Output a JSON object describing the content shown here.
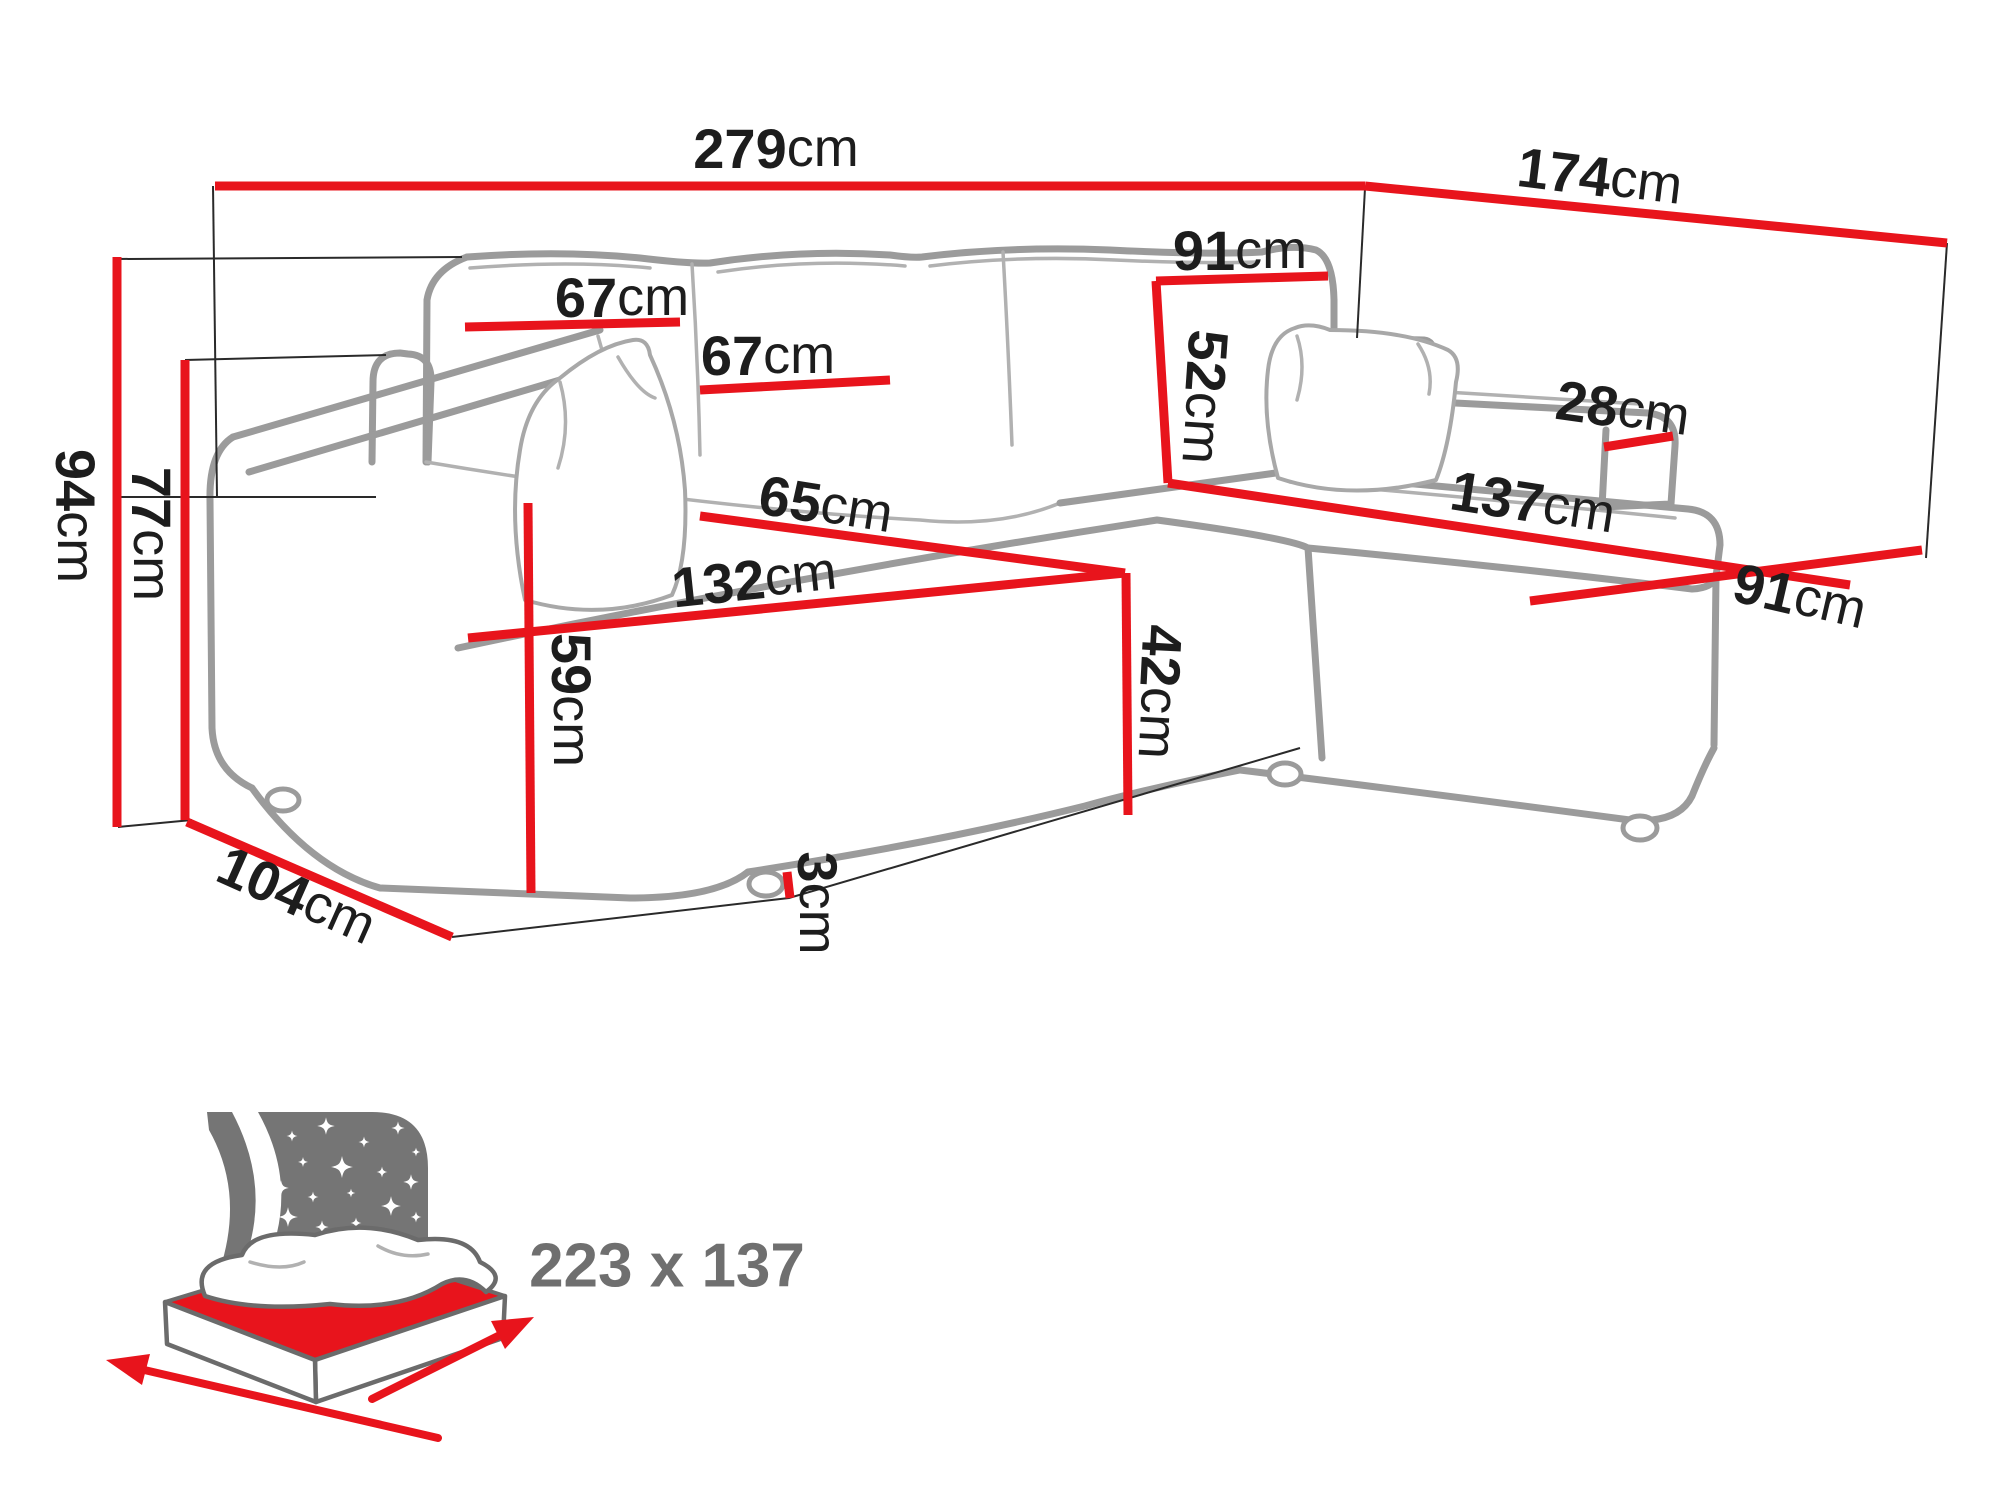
{
  "title": "Corner sofa bed dimensions diagram",
  "unit": "cm",
  "colors": {
    "dimension_line_red": "#e8141c",
    "sketch_gray": "#9b9b9b",
    "label_black": "#1d1d1d",
    "bed_icon_gray": "#757575",
    "bed_size_text_gray": "#6f6f6f",
    "background": "#ffffff"
  },
  "dimensions": {
    "overall_width": {
      "value": "279",
      "unit": "cm"
    },
    "overall_depth": {
      "value": "174",
      "unit": "cm"
    },
    "overall_height": {
      "value": "94",
      "unit": "cm"
    },
    "backrest_height": {
      "value": "77",
      "unit": "cm"
    },
    "body_depth": {
      "value": "104",
      "unit": "cm"
    },
    "back_cushion_width_left": {
      "value": "67",
      "unit": "cm"
    },
    "back_cushion_width_mid": {
      "value": "67",
      "unit": "cm"
    },
    "corner_section_width": {
      "value": "91",
      "unit": "cm"
    },
    "corner_backrest_height": {
      "value": "52",
      "unit": "cm"
    },
    "armrest_width": {
      "value": "28",
      "unit": "cm"
    },
    "chaise_length": {
      "value": "137",
      "unit": "cm"
    },
    "chaise_width": {
      "value": "91",
      "unit": "cm"
    },
    "seat_depth": {
      "value": "65",
      "unit": "cm"
    },
    "seat_width": {
      "value": "132",
      "unit": "cm"
    },
    "seat_height": {
      "value": "42",
      "unit": "cm"
    },
    "armrest_height": {
      "value": "59",
      "unit": "cm"
    },
    "leg_height": {
      "value": "3",
      "unit": "cm"
    }
  },
  "sleeping_area": {
    "label": "223 x 137"
  }
}
